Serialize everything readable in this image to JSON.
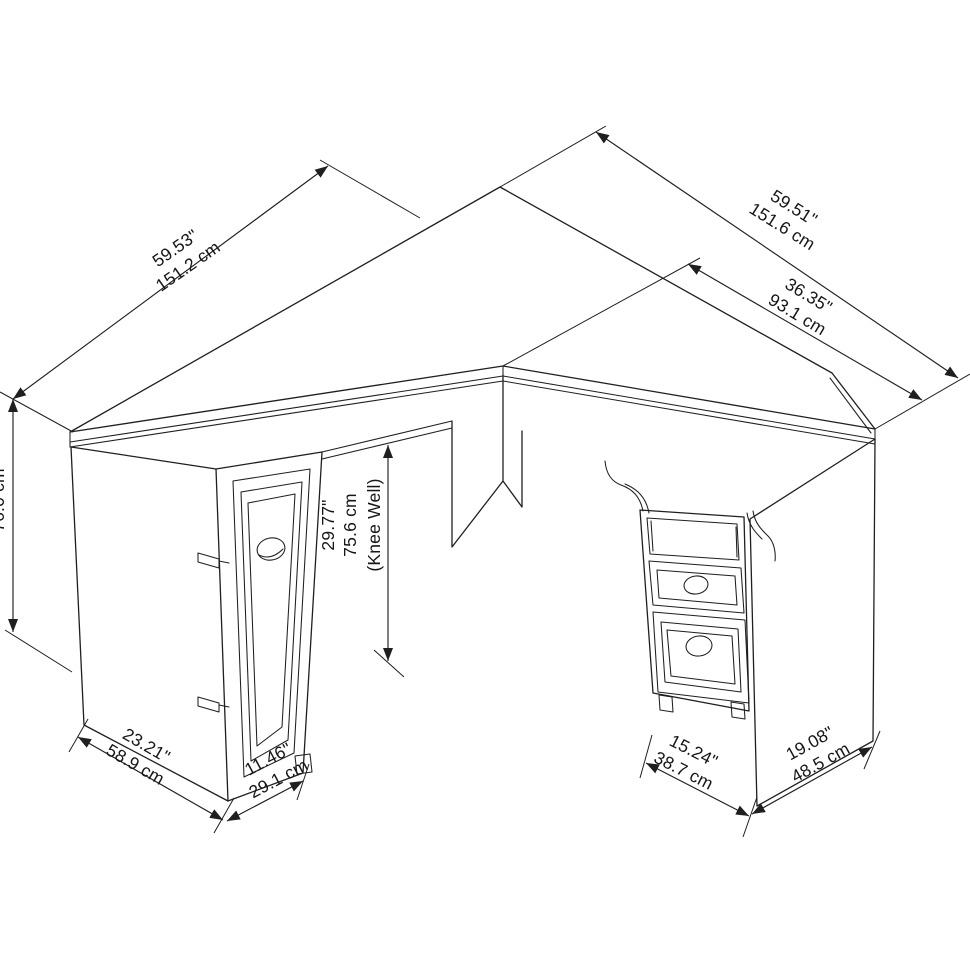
{
  "figure": {
    "kind": "technical line drawing",
    "subject": "L-shaped corner desk isometric view with dimension callouts",
    "background": "#ffffff",
    "line_color": "#1f1f1f"
  },
  "dims": {
    "left_top_length": {
      "in": "59.53\"",
      "cm": "151.2 cm"
    },
    "right_top_length": {
      "in": "59.51\"",
      "cm": "151.6 cm"
    },
    "right_top_depth": {
      "in": "36.35\"",
      "cm": "93.1 cm"
    },
    "overall_height": {
      "cm": "76.0 cm"
    },
    "knee_well": {
      "in": "29.77\"",
      "cm": "75.6 cm",
      "note": "(Knee Well)"
    },
    "left_cabinet_depth": {
      "in": "23.21\"",
      "cm": "58.9 cm"
    },
    "left_door_width": {
      "in": "11.46\"",
      "cm": "29.1 cm"
    },
    "pedestal_width": {
      "in": "15.24\"",
      "cm": "38.7 cm"
    },
    "right_end_depth": {
      "in": "19.08\"",
      "cm": "48.5 cm"
    }
  }
}
